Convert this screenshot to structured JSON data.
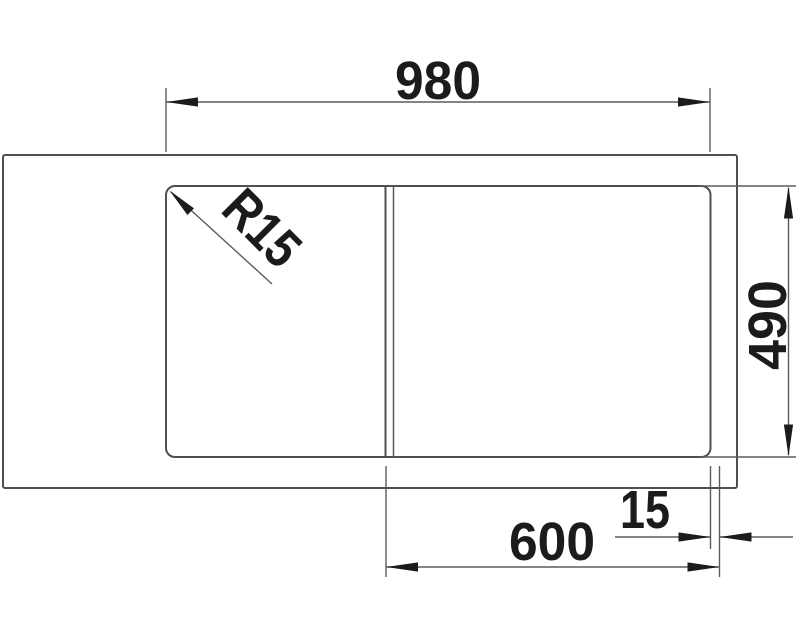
{
  "drawing": {
    "dim_total_width": "980",
    "dim_total_depth": "490",
    "dim_bowl_cutout_width": "600",
    "dim_rim_offset": "15",
    "dim_corner_radius": "R15",
    "colors": {
      "line": "#4f4f4f",
      "dimension_line": "#5c5c5c",
      "ink": "#1b1b1b",
      "background": "#ffffff"
    }
  }
}
